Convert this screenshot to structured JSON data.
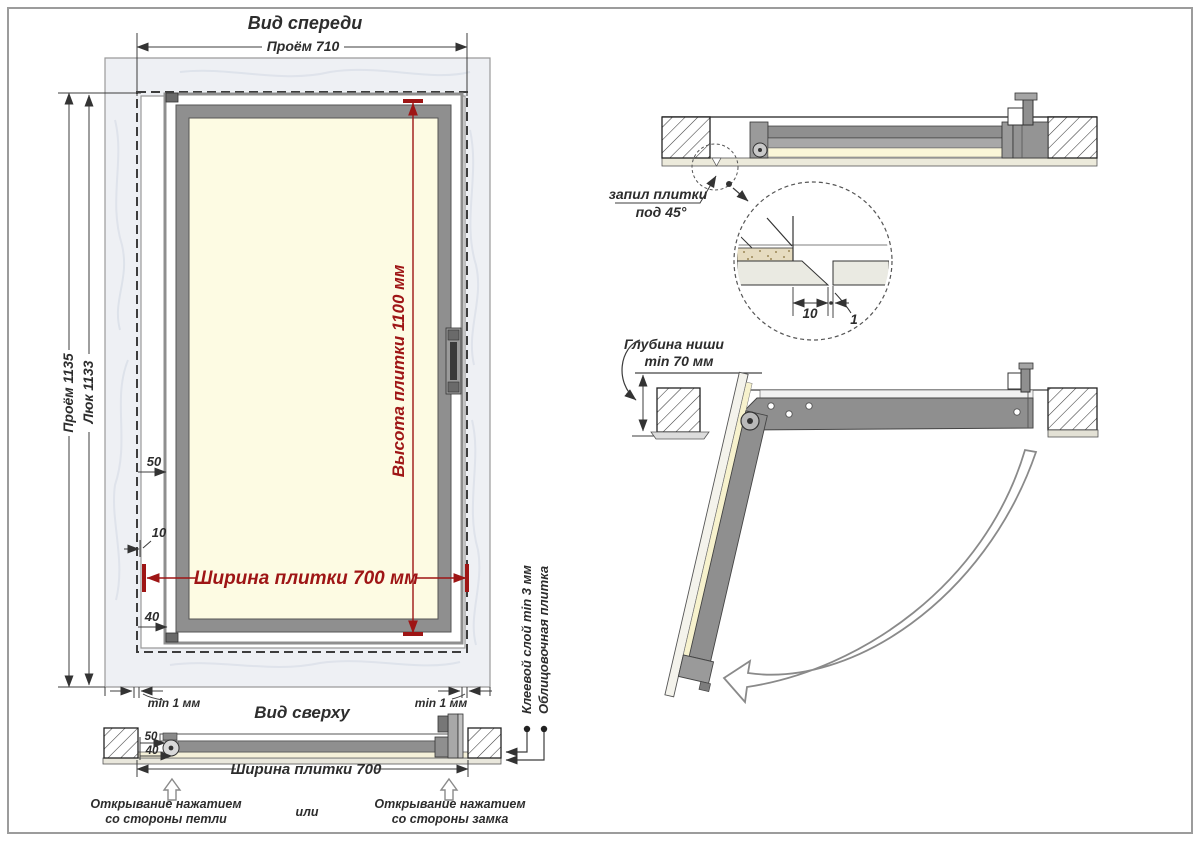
{
  "palette": {
    "accent_red": "#9e1515",
    "frame_gray": "#8f8f8f",
    "tile_yellow": "#fdfbe3",
    "marble_gray": "#eef0f4",
    "line_dark": "#333333"
  },
  "front_view": {
    "title": "Вид спереди",
    "dim_opening_width": "Проём 710",
    "dim_opening_height": "Проём 1135",
    "dim_hatch_height": "Люк 1133",
    "dim_tile_height": "Высота плитки 1100 мм",
    "dim_tile_width": "Ширина плитки 700 мм",
    "dim_top_offset": "50",
    "dim_gap": "10",
    "dim_bottom_offset": "40",
    "min_gap_left": "min 1 мм",
    "min_gap_right": "min 1 мм"
  },
  "top_view": {
    "title": "Вид сверху",
    "dim_50": "50",
    "dim_40": "40",
    "dim_tile_width": "Ширина плитки 700",
    "open_hinge_line1": "Открывание нажатием",
    "open_hinge_line2": "со стороны петли",
    "or_label": "или",
    "open_lock_line1": "Открывание нажатием",
    "open_lock_line2": "со стороны замка",
    "label_glue_layer": "Клеевой слой min 3 мм",
    "label_facing_tile": "Облицовочная плитка"
  },
  "section_view": {
    "cut_label_line1": "запил плитки",
    "cut_label_line2": "под 45°",
    "detail_dim_width": "10",
    "detail_dim_gap": "1"
  },
  "open_view": {
    "depth_label_line1": "Глубина ниши",
    "depth_label_line2": "min 70 мм"
  }
}
